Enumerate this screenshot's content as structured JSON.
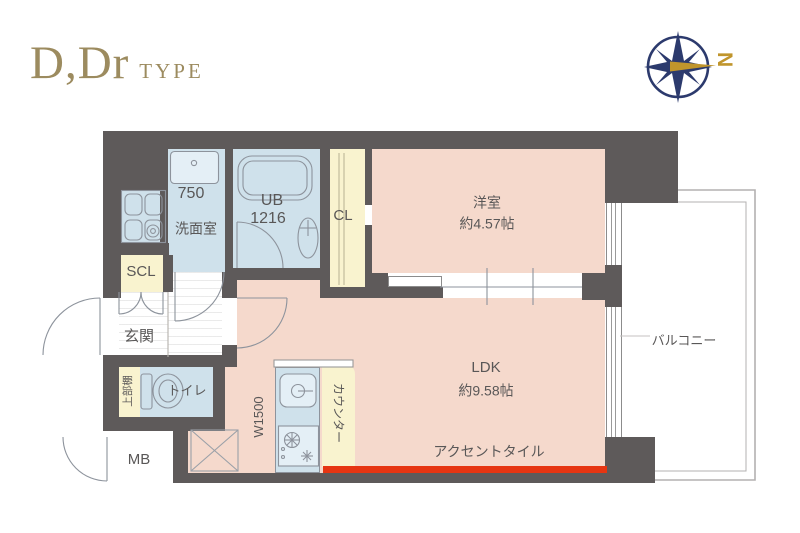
{
  "title": {
    "main": "D,Dr",
    "suffix": "TYPE"
  },
  "compass": {
    "label": "N",
    "icon": "compass-rose",
    "navy": "#2c3a6d",
    "gold": "#c0952c"
  },
  "rooms": {
    "washroom": {
      "size": "750",
      "name": "洗面室"
    },
    "bath": {
      "name": "UB",
      "size": "1216"
    },
    "closet": {
      "name": "CL"
    },
    "western": {
      "name": "洋室",
      "size": "約4.57帖"
    },
    "shoe_closet": {
      "name": "SCL"
    },
    "entrance": {
      "name": "玄関"
    },
    "toilet": {
      "name": "トイレ"
    },
    "upper_shelf": {
      "name": "上部棚"
    },
    "kitchen": {
      "size": "W1500"
    },
    "counter": {
      "name": "カウンター"
    },
    "ldk": {
      "name": "LDK",
      "size": "約9.58帖"
    },
    "accent_tile": {
      "name": "アクセントタイル"
    },
    "balcony": {
      "name": "バルコニー"
    },
    "meter_box": {
      "name": "MB"
    }
  },
  "colors": {
    "wall": "#5e5a5a",
    "wet_area_fill": "#cfe1eb",
    "living_fill": "#f5d9cc",
    "storage_fill": "#f9f3cf",
    "accent_tile": "#e63512",
    "title_text": "#9c8b5f",
    "label_text": "#595757"
  }
}
